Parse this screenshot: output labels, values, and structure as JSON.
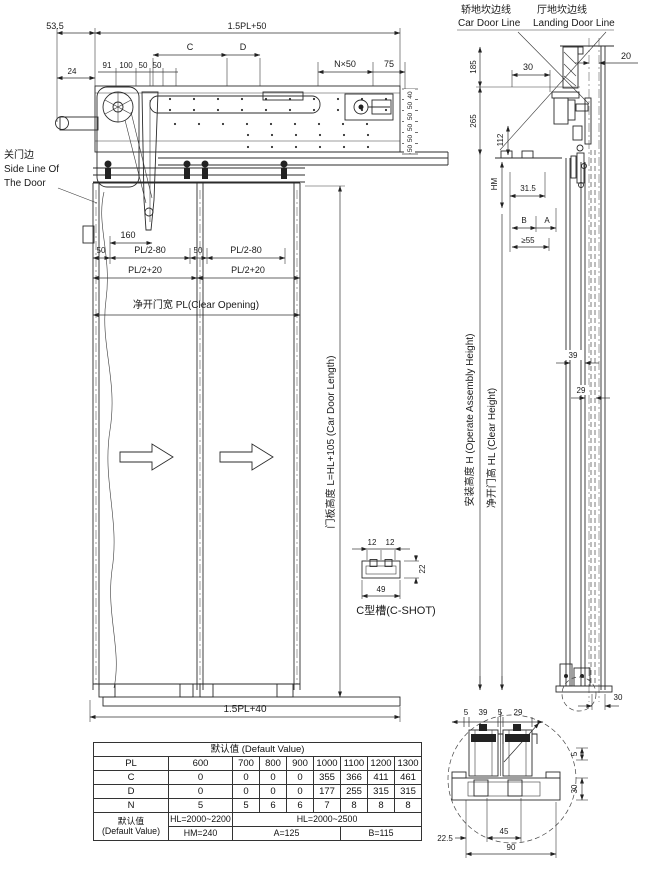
{
  "drawing": {
    "front": {
      "d535": "53.5",
      "d15pl50": "1.5PL+50",
      "dC": "C",
      "dD": "D",
      "dn50": "N×50",
      "d75": "75",
      "d24": "24",
      "d91": "91",
      "d100": "100",
      "d50a": "50",
      "d50b": "50",
      "stack": [
        "40",
        "50",
        "50",
        "50",
        "50",
        "50"
      ],
      "side1": "关门边",
      "side2": "Side Line Of",
      "side3": "The Door",
      "d160": "160",
      "d50L": "50",
      "dpl2m80a": "PL/2-80",
      "d50R": "50",
      "dpl2m80b": "PL/2-80",
      "dpl2p20a": "PL/2+20",
      "dpl2p20b": "PL/2+20",
      "clear_opening": "净开门宽 PL(Clear Opening)",
      "door_length": "门板高度 L=HL+105 (Car Door Length)",
      "d15pl40": "1.5PL+40"
    },
    "cch": {
      "d12a": "12",
      "d12b": "12",
      "d22": "22",
      "d49": "49",
      "label": "C型槽(C-SHOT)"
    },
    "sec": {
      "car_zh": "轿地坎边线",
      "car_en": "Car Door Line",
      "land_zh": "厅地坎边线",
      "land_en": "Landing Door Line",
      "d185": "185",
      "d30": "30",
      "d20": "20",
      "d265": "265",
      "d112": "112",
      "dHM": "HM",
      "d315": "31.5",
      "dB": "B",
      "dA": "A",
      "d55": "≥55",
      "d39": "39",
      "d29": "29",
      "h_label": "安装高度 H (Operate Assembly Height)",
      "hl_label": "净开门高 HL (Clear Height)",
      "d30s": "30"
    },
    "det": {
      "d5a": "5",
      "d39": "39",
      "d5b": "5",
      "d29": "29",
      "d5r": "5",
      "d30r": "30",
      "d225": "22.5",
      "d45": "45",
      "d90": "90"
    }
  },
  "table": {
    "title": "默认值 (Default Value)",
    "rows": [
      {
        "label": "PL",
        "values": [
          "600",
          "700",
          "800",
          "900",
          "1000",
          "1100",
          "1200",
          "1300"
        ]
      },
      {
        "label": "C",
        "values": [
          "0",
          "0",
          "0",
          "0",
          "355",
          "366",
          "411",
          "461"
        ]
      },
      {
        "label": "D",
        "values": [
          "0",
          "0",
          "0",
          "0",
          "177",
          "255",
          "315",
          "315"
        ]
      },
      {
        "label": "N",
        "values": [
          "5",
          "5",
          "6",
          "6",
          "7",
          "8",
          "8",
          "8"
        ]
      }
    ],
    "footer_label_zh": "默认值",
    "footer_label_en": "(Default Value)",
    "hl_range1": "HL=2000~2200",
    "hl_range2": "HL=2000~2500",
    "hm_value": "HM=240",
    "a_value": "A=125",
    "b_value": "B=115"
  }
}
